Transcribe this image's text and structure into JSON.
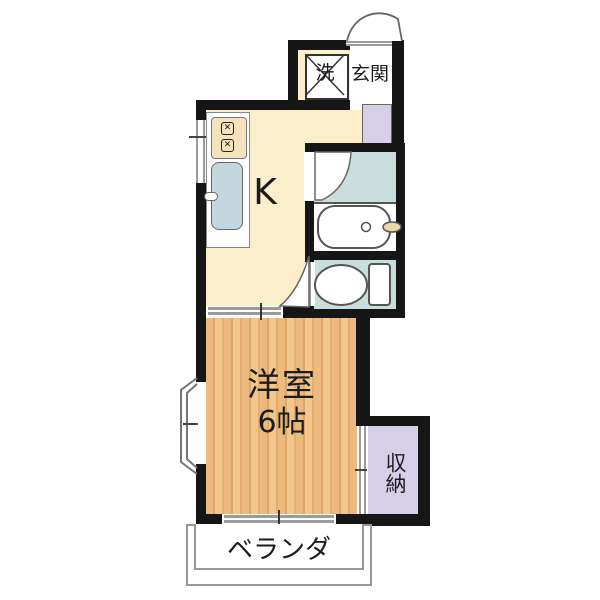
{
  "plan": {
    "type": "apartment-floorplan-1K",
    "rooms": {
      "washer": {
        "label": "洗"
      },
      "entrance": {
        "label": "玄関"
      },
      "kitchen": {
        "label": "K"
      },
      "western_room": {
        "label": "洋室",
        "size": "6帖"
      },
      "storage": {
        "label": "収納"
      },
      "veranda": {
        "label": "ベランダ"
      }
    },
    "fixtures": {
      "stove": {
        "burner_glyph": "✕",
        "burner_count": 2
      }
    },
    "colors": {
      "wall": "#161616",
      "kitchen_floor": "#faeecb",
      "wet_area_floor": "#cbdede",
      "storage_fill": "#d7cfe7",
      "wood_light": "#f2c78e",
      "wood_dark": "#dfa765",
      "fixture_outline": "#555555",
      "faucet_knob": "#e9d7a5",
      "opening_line": "#9a9a9a"
    }
  }
}
